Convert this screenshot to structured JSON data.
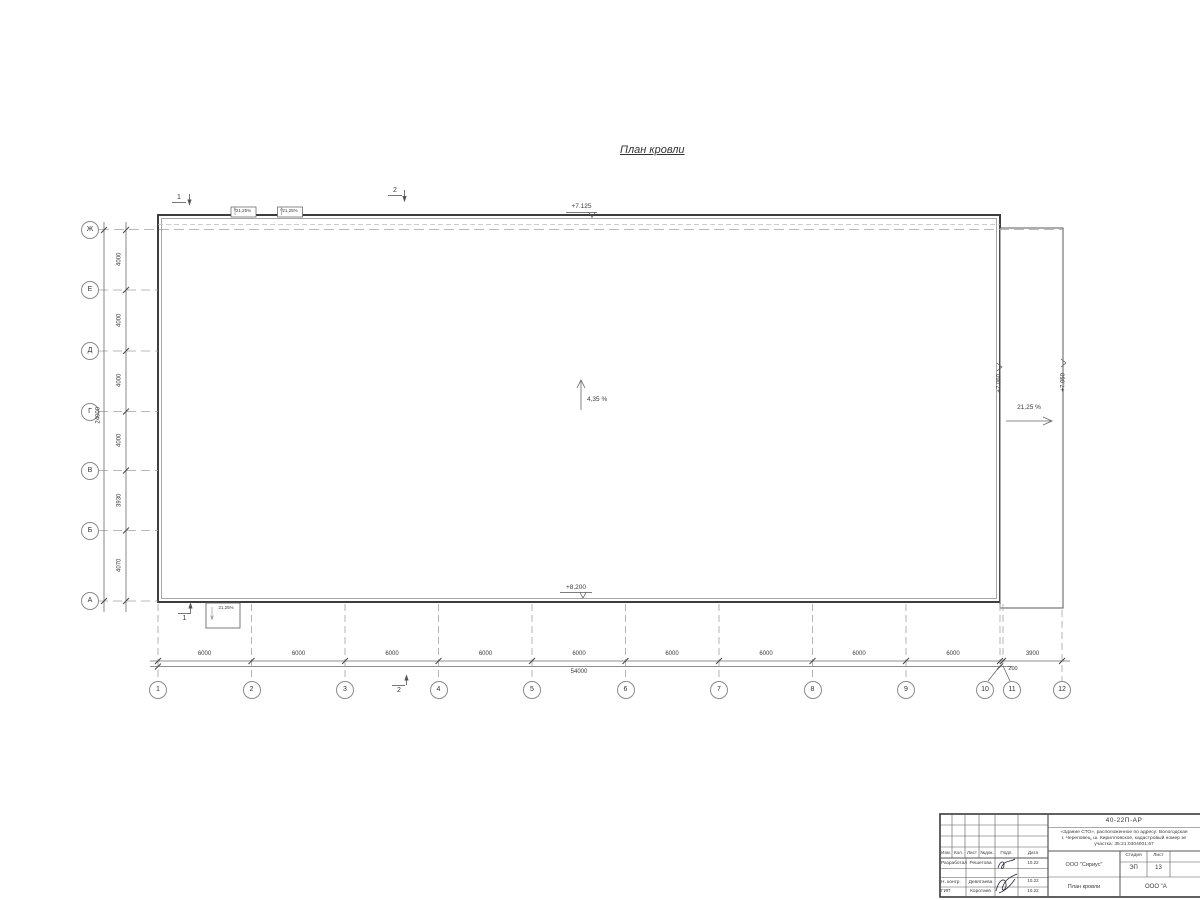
{
  "title": "План кровли",
  "levels": {
    "top": "+7.125",
    "bottom": "+8.200",
    "right_inner": "+7.060",
    "right_outer": "+7.050"
  },
  "slopes": {
    "main": "4,35 %",
    "right": "21,25 %",
    "canopy": "21,25%"
  },
  "sections": [
    "1",
    "2",
    "1",
    "2"
  ],
  "axes": {
    "rows": [
      "Ж",
      "Е",
      "Д",
      "Г",
      "В",
      "Б",
      "А"
    ],
    "row_dims": [
      "4000",
      "4000",
      "4000",
      "4000",
      "3930",
      "4070"
    ],
    "row_total": "24000",
    "cols": [
      "1",
      "2",
      "3",
      "4",
      "5",
      "6",
      "7",
      "8",
      "9",
      "10",
      "11",
      "12"
    ],
    "col_dims": [
      "6000",
      "6000",
      "6000",
      "6000",
      "6000",
      "6000",
      "6000",
      "6000",
      "6000"
    ],
    "col_dim_right": "3900",
    "col_dim_small": "200",
    "col_total": "54000"
  },
  "titleblock": {
    "doc_number": "40-22П-АР",
    "desc_line1": "«Здание СТО», расположенное по адресу: Вологодская",
    "desc_line2": "г. Череповец, ш. Кирилловское, кадастровый номер зе",
    "desc_line3": "участка: 35:21:0304001:67",
    "cols": [
      "Изм.",
      "Кол.",
      "Лист",
      "№док.",
      "Подп.",
      "Дата"
    ],
    "rows": [
      {
        "role": "Разработал",
        "name": "Решетова",
        "date": "10.22"
      },
      {
        "role": "Н. контр.",
        "name": "Девятаева",
        "date": "10.22"
      },
      {
        "role": "ГИП",
        "name": "Коротаев",
        "date": "10.22"
      }
    ],
    "org": "ООО \"Сириус\"",
    "stage_label": "Стадия",
    "sheet_label": "Лист",
    "stage": "ЭП",
    "sheet_no": "13",
    "sheet_title": "План кровли",
    "org2": "ООО \"А"
  }
}
